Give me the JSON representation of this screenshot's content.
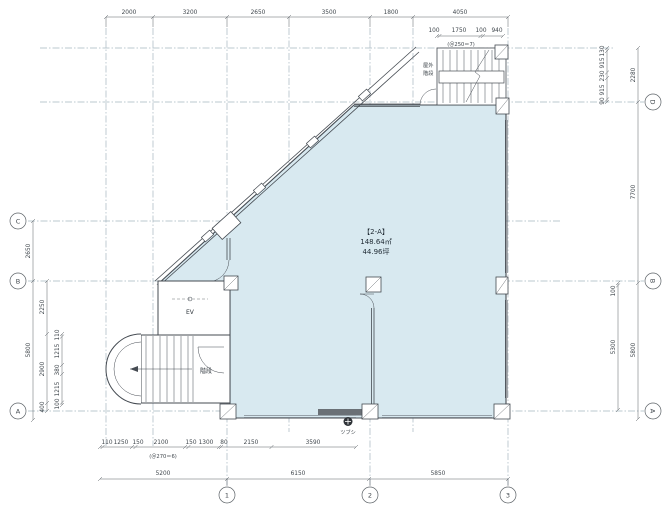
{
  "room": {
    "name": "【2-A】",
    "area_m2": "148.64㎡",
    "area_tsubo": "44.96坪"
  },
  "labels": {
    "elevator": "EV",
    "stairs": "階段",
    "outdoor_stairs_l1": "屋外",
    "outdoor_stairs_l2": "階段",
    "tsubushi": "ツブシ"
  },
  "notes": {
    "top_stair": "(＠250＝7)",
    "bottom_stair": "(＠270＝6)"
  },
  "grid": {
    "bottom": [
      "1",
      "2",
      "3"
    ],
    "left": [
      "C",
      "B",
      "A"
    ],
    "right": [
      "D",
      "B",
      "A"
    ]
  },
  "dims": {
    "top": [
      "2000",
      "3200",
      "2650",
      "3500",
      "1800",
      "4050"
    ],
    "top_sub": [
      "100",
      "1750",
      "100",
      "940"
    ],
    "bottom_sub": [
      "110",
      "1250",
      "150",
      "2100",
      "150",
      "1300",
      "80",
      "2150",
      "3590"
    ],
    "bottom_main": [
      "5200",
      "6150",
      "5850"
    ],
    "left_outer": [
      "2650",
      "5800"
    ],
    "left_mid": [
      "2250",
      "2900",
      "400"
    ],
    "left_small": [
      "110",
      "1215",
      "380",
      "1215",
      "100"
    ],
    "right_small": [
      "130",
      "915",
      "230",
      "915",
      "90"
    ],
    "right_outer": [
      "2280",
      "7700",
      "5800"
    ],
    "right_inner": [
      "100",
      "5300"
    ]
  },
  "colors": {
    "room_fill": "#d8e9f0",
    "wall": "#454b52",
    "grid": "#a5b6c0",
    "dim": "#5b6166",
    "solid_band": "#6a7076"
  }
}
